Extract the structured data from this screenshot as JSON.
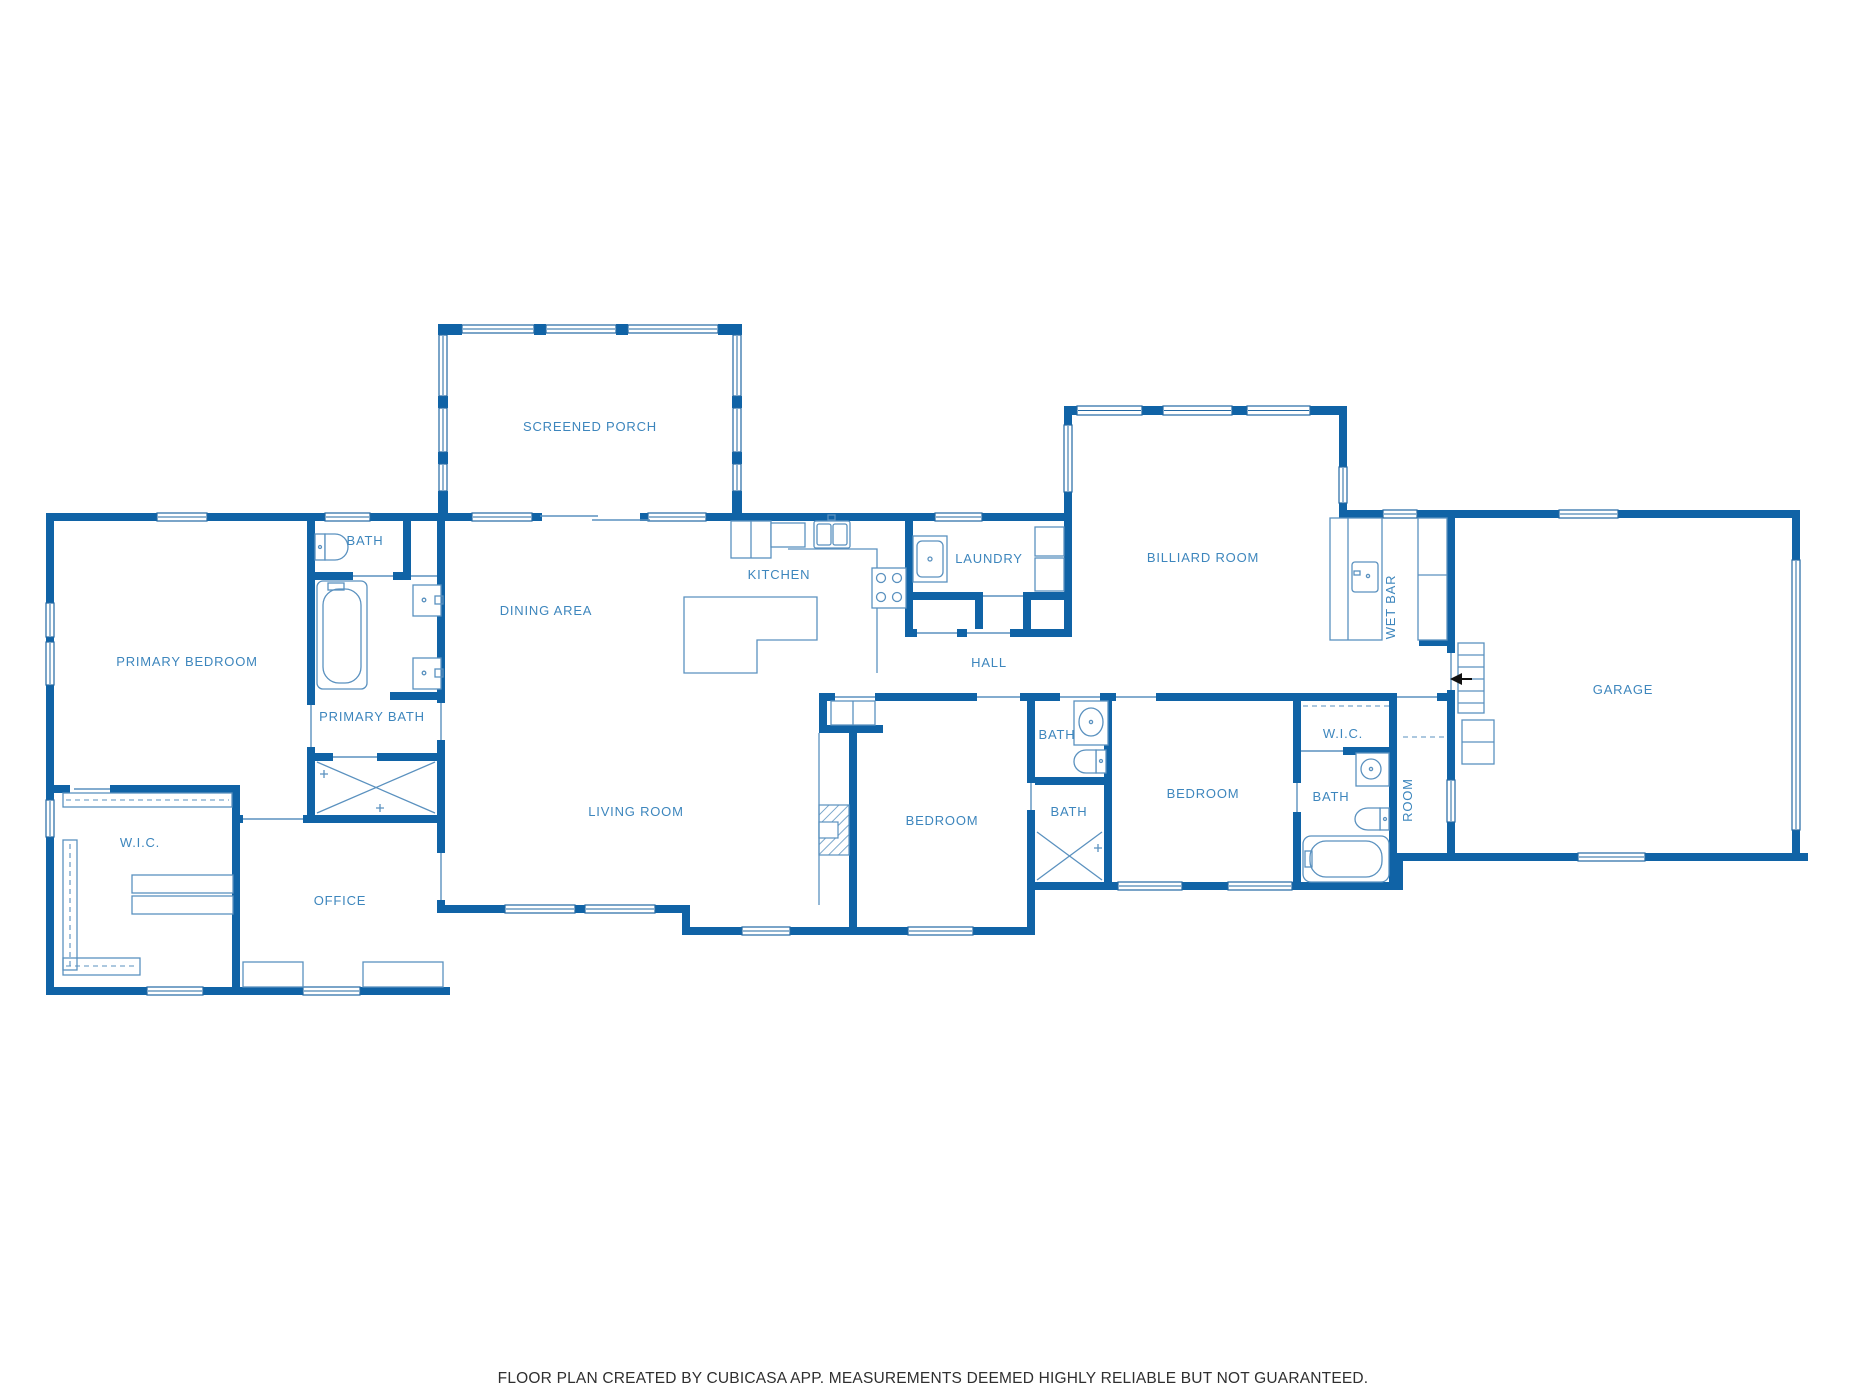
{
  "title": "Residential floor plan",
  "colors": {
    "wall": "#1063a6",
    "window_stroke": "#2268a3",
    "fixture_line": "#5a91bf",
    "label_text": "#3d86bd",
    "footer_text": "#2f2f2f",
    "background": "#ffffff"
  },
  "rooms": {
    "screened_porch": {
      "label": "SCREENED PORCH"
    },
    "bath_primary_hall": {
      "label": "BATH"
    },
    "primary_bedroom": {
      "label": "PRIMARY BEDROOM"
    },
    "primary_bath": {
      "label": "PRIMARY BATH"
    },
    "dining_area": {
      "label": "DINING AREA"
    },
    "kitchen": {
      "label": "KITCHEN"
    },
    "laundry": {
      "label": "LAUNDRY"
    },
    "hall": {
      "label": "HALL"
    },
    "billiard_room": {
      "label": "BILLIARD ROOM"
    },
    "wet_bar": {
      "label": "WET BAR"
    },
    "garage": {
      "label": "GARAGE"
    },
    "living_room": {
      "label": "LIVING ROOM"
    },
    "wic_primary": {
      "label": "W.I.C."
    },
    "office": {
      "label": "OFFICE"
    },
    "bedroom_1": {
      "label": "BEDROOM"
    },
    "bath_hall": {
      "label": "BATH"
    },
    "bath_ensuite_1": {
      "label": "BATH"
    },
    "bedroom_2": {
      "label": "BEDROOM"
    },
    "wic_2": {
      "label": "W.I.C."
    },
    "bath_2": {
      "label": "BATH"
    },
    "room": {
      "label": "ROOM"
    }
  },
  "footer": {
    "text": "FLOOR PLAN CREATED BY CUBICASA APP. MEASUREMENTS DEEMED HIGHLY RELIABLE BUT NOT GUARANTEED."
  }
}
